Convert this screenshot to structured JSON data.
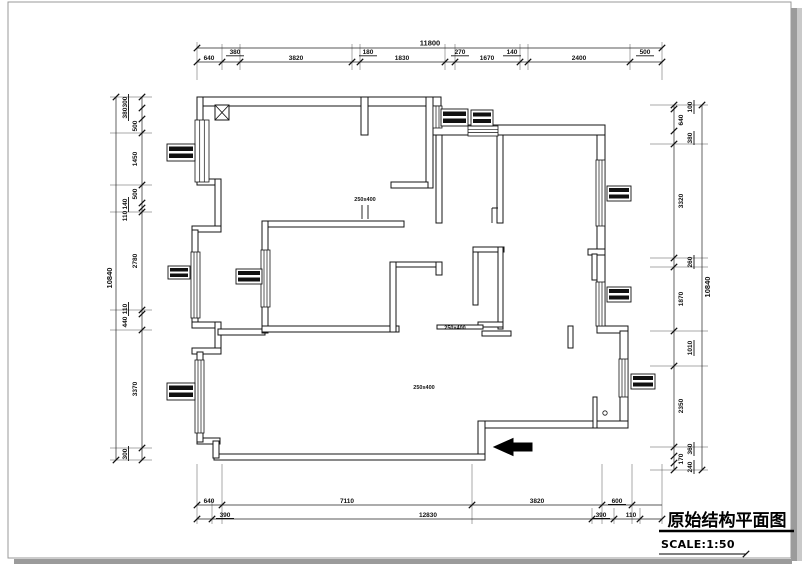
{
  "page": {
    "title": "原始结构平面图",
    "scale_label": "SCALE:1:50"
  },
  "dimensions": {
    "top": {
      "total": "11800",
      "segments": [
        "640",
        "380",
        "3820",
        "180",
        "1830",
        "270",
        "1670",
        "140",
        "2400",
        "500"
      ]
    },
    "left": {
      "total": "10840",
      "segments": [
        "300",
        "380",
        "500",
        "1450",
        "500",
        "140",
        "110",
        "2780",
        "110",
        "440",
        "3370",
        "300"
      ]
    },
    "right": {
      "total": "10840",
      "segments": [
        "100",
        "640",
        "380",
        "3320",
        "260",
        "1870",
        "1010",
        "2350",
        "360",
        "170",
        "240"
      ]
    },
    "bottom": {
      "tier1": [
        "640",
        "7110",
        "3820",
        "600"
      ],
      "tier2": [
        "390",
        "12830",
        "390",
        "110"
      ]
    }
  },
  "annotations": {
    "beam_labels": [
      "250x400",
      "250x400",
      "250x400"
    ]
  },
  "symbols": {
    "entry_arrow": "solid-left-arrow",
    "column_marker": "x-crossed-box",
    "window_symbol": "multi-line-glazing",
    "label_tag": "black-text-tag"
  },
  "colors": {
    "line": "#141414",
    "dim_text": "#111111",
    "page_border": "#999999",
    "shadow": "#9b9b9b"
  }
}
